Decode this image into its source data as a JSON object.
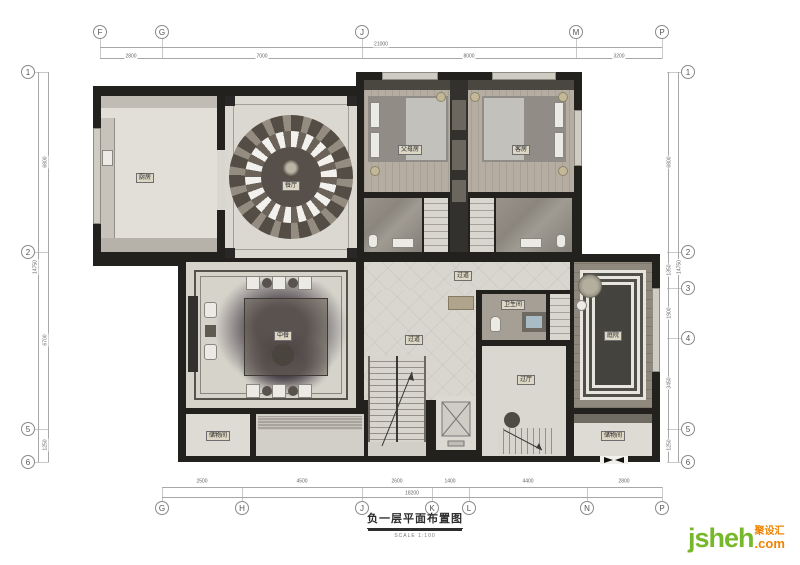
{
  "title": {
    "text": "负一层平面布置图",
    "scale": "SCALE  1:100"
  },
  "grid": {
    "top": [
      "F",
      "G",
      "J",
      "M",
      "P"
    ],
    "bottom": [
      "G",
      "H",
      "J",
      "K",
      "L",
      "N",
      "P"
    ],
    "left": [
      "1",
      "2",
      "5",
      "6"
    ],
    "right": [
      "1",
      "2",
      "3",
      "4",
      "5",
      "6"
    ]
  },
  "dims": {
    "top_total": "21000",
    "top_segments": [
      "2800",
      "7000",
      "8000",
      "3200"
    ],
    "bottom_total": "18200",
    "bottom_segments": [
      "2500",
      "4500",
      "2600",
      "1400",
      "4400",
      "2800"
    ],
    "left_total": "14750",
    "left_segments": [
      "6800",
      "6700",
      "1250"
    ],
    "right_total": "14750",
    "right_segments": [
      "6800",
      "1350",
      "1900",
      "3450",
      "1250"
    ]
  },
  "rooms": {
    "kitchen": "厨房",
    "dining": "餐厅",
    "parents_room": "父母房",
    "guest_room": "客房",
    "corridor_upper": "过道",
    "corridor_main": "过道",
    "bathroom": "卫生间",
    "hall": "过厅",
    "chinese_dining": "中餐",
    "courtyard": "庭院",
    "storage_left": "储物间",
    "storage_right": "储物间"
  },
  "watermark": {
    "name": "jsheh",
    "tld": ".com",
    "cn": "聚设汇"
  },
  "colors": {
    "wall": "#23211e",
    "floor": "#d9d6cf",
    "wood_floor": "#b5ada2",
    "logo_green": "#76b82a",
    "logo_orange": "#f08300"
  }
}
